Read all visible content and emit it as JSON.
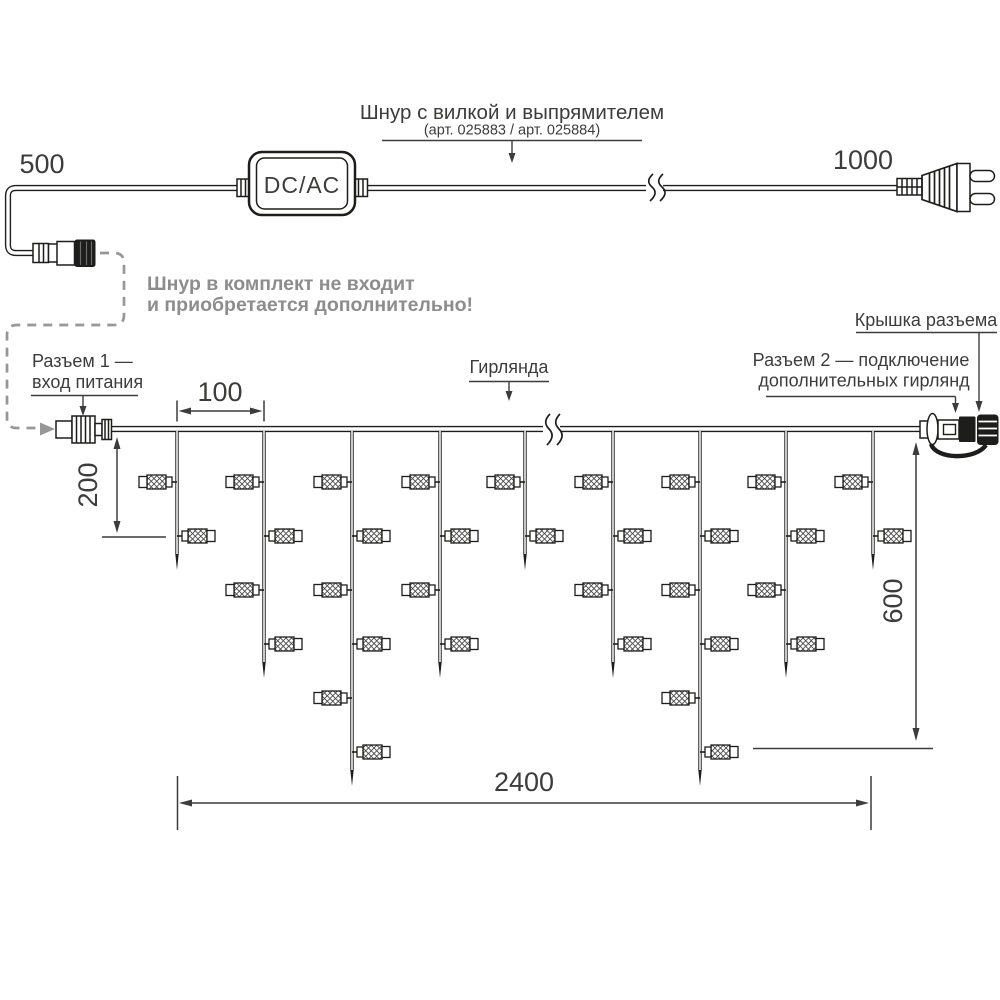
{
  "power_section": {
    "cord_label": "Шнур с вилкой и выпрямителем",
    "cord_sublabel": "(арт. 025883 / арт. 025884)",
    "dim_left": "500",
    "dim_right": "1000",
    "converter": "DC/AC",
    "note1": "Шнур в комплект не входит",
    "note2": "и приобретается дополнительно!"
  },
  "garland_section": {
    "garland_label": "Гирлянда",
    "connector1_line1": "Разъем 1 —",
    "connector1_line2": "вход питания",
    "connector2_line1": "Разъем 2 — подключение",
    "connector2_line2": "дополнительных гирлянд",
    "cap_label": "Крышка разъема",
    "dim_spacing": "100",
    "dim_short_drop": "200",
    "dim_long_drop": "600",
    "dim_total": "2400"
  },
  "structure": {
    "wire_y": 429,
    "strand_top_y": 431,
    "lamp_row_start_y": 482,
    "lamp_row_spacing": 54,
    "strand_xs": [
      177,
      264,
      352,
      440,
      525,
      613,
      700,
      786,
      873
    ],
    "strand_lamp_counts": [
      2,
      4,
      6,
      4,
      2,
      4,
      6,
      4,
      2
    ]
  },
  "colors": {
    "ink": "#1d1d1b",
    "label_text": "#3c3c3b",
    "gray": "#8d8d8d"
  }
}
